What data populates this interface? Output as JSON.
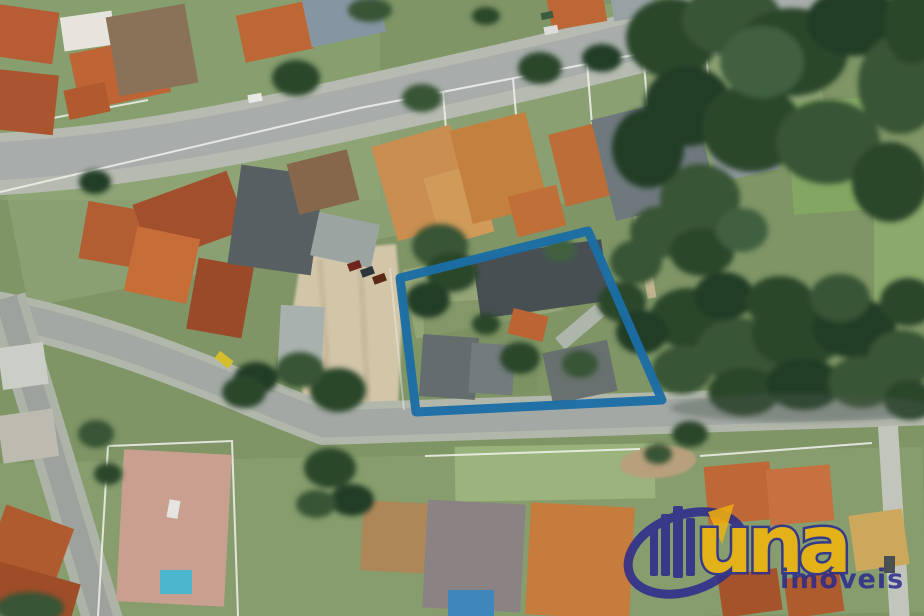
{
  "watermark": {
    "brand_text": "una",
    "subtitle_text": "imóveis",
    "navy_color": "#2a2a8e",
    "yellow_color": "#f3b70a"
  },
  "annotation": {
    "label": "property-boundary",
    "stroke_color": "#1b6da6",
    "stroke_width": "9",
    "points": "400,278 588,231 662,400 416,412"
  }
}
